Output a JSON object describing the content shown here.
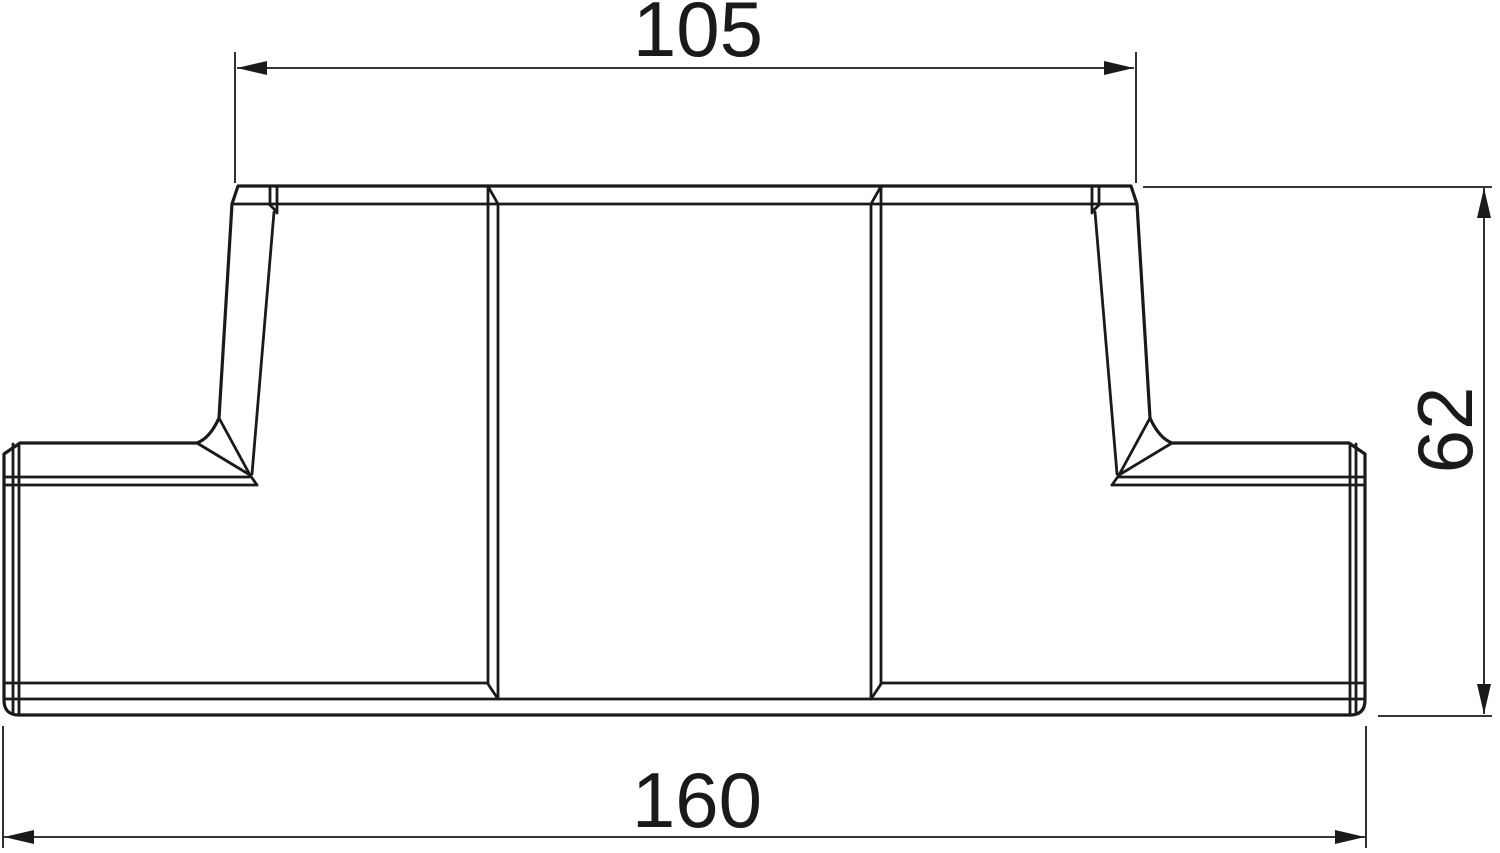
{
  "drawing": {
    "dimensions": {
      "top_width": "105",
      "height": "62",
      "total_width": "160"
    },
    "colors": {
      "line": "#1a1a1a",
      "background": "#ffffff"
    }
  }
}
